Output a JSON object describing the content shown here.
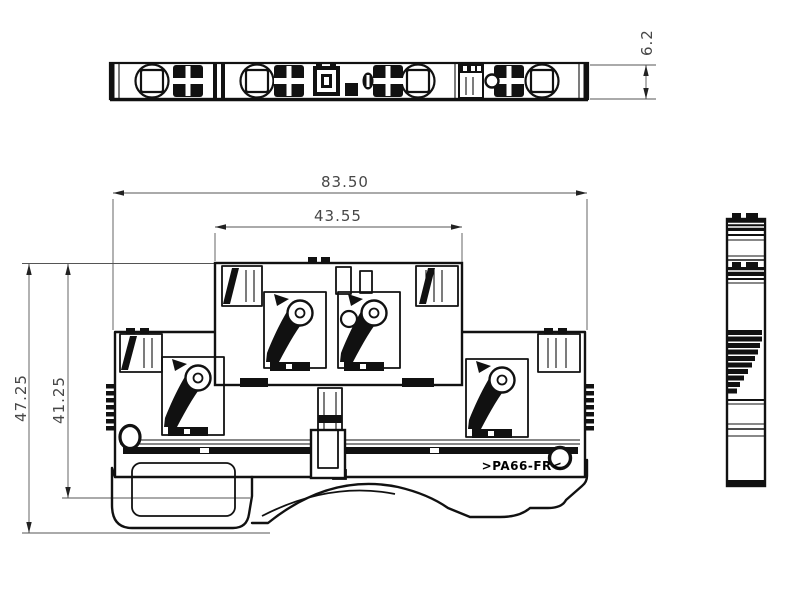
{
  "drawing": {
    "type": "technical dimension drawing - DIN rail double-level terminal block",
    "background_color": "#ffffff",
    "line_color": "#111111",
    "dimension_text_color": "#474747",
    "material_marking": ">PA66-FR<",
    "dimensions": {
      "overall_width_mm": "83.50",
      "upper_level_width_mm": "43.55",
      "total_height_mm": "47.25",
      "body_height_mm": "41.25",
      "block_thickness_mm": "6.2"
    }
  }
}
